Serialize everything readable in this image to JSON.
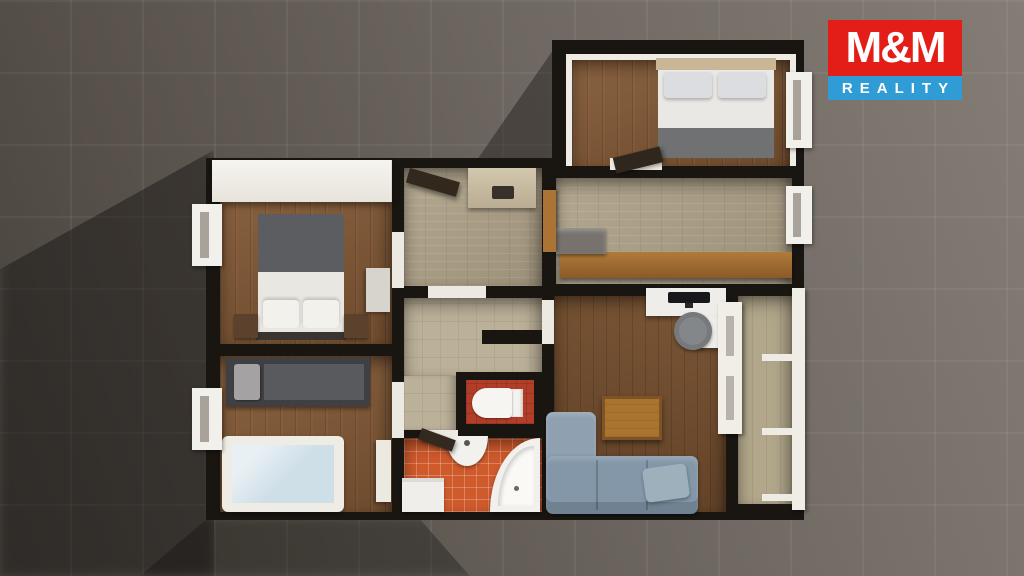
{
  "logo": {
    "brand": "M&M",
    "tagline": "REALITY",
    "brand_bg": "#e31e18",
    "tagline_bg": "#2f9cd6",
    "text_color": "#ffffff"
  },
  "scene": {
    "type": "3d-top-down-floorplan-render",
    "background": {
      "tile_color": "#6f6862",
      "shadow_color": "#2b2724"
    },
    "palette": {
      "wall": "#191511",
      "wall_face_white": "#efece5",
      "wood_floor": "#7b5838",
      "wood_floor_dark": "#6b4a2e",
      "stone_tile": "#a89c85",
      "beige_tile": "#bbb098",
      "orange_tile": "#cf5a2c",
      "wc_floor": "#b23d28",
      "sofa_blue": "#8397a9",
      "counter_wood": "#9c6a33",
      "bed_blanket_gray": "#5b5d61",
      "crib_blue": "#cfdfe8"
    },
    "rooms": [
      {
        "name": "bedroom-master",
        "furniture": [
          "wardrobe",
          "double-bed",
          "pillows",
          "nightstands",
          "dresser",
          "window"
        ]
      },
      {
        "name": "bedroom-kids",
        "furniture": [
          "single-bed",
          "crib",
          "window",
          "door-leaf"
        ]
      },
      {
        "name": "entrance-hall",
        "furniture": [
          "entrance-door",
          "shoe-cabinet"
        ]
      },
      {
        "name": "kitchen-corridor",
        "furniture": [
          "kitchen-counter",
          "appliance",
          "window",
          "wood-door"
        ]
      },
      {
        "name": "bedroom-upper",
        "furniture": [
          "double-bed",
          "pillows",
          "window",
          "door"
        ]
      },
      {
        "name": "inner-corridor",
        "furniture": []
      },
      {
        "name": "wc",
        "furniture": [
          "toilet"
        ]
      },
      {
        "name": "bathroom",
        "furniture": [
          "sink",
          "corner-bathtub",
          "washing-machine",
          "door"
        ]
      },
      {
        "name": "living-room",
        "furniture": [
          "desk",
          "monitor",
          "office-chair",
          "coffee-table",
          "corner-sofa",
          "pillow"
        ]
      },
      {
        "name": "balcony",
        "furniture": [
          "railing",
          "balcony-door"
        ]
      }
    ]
  }
}
